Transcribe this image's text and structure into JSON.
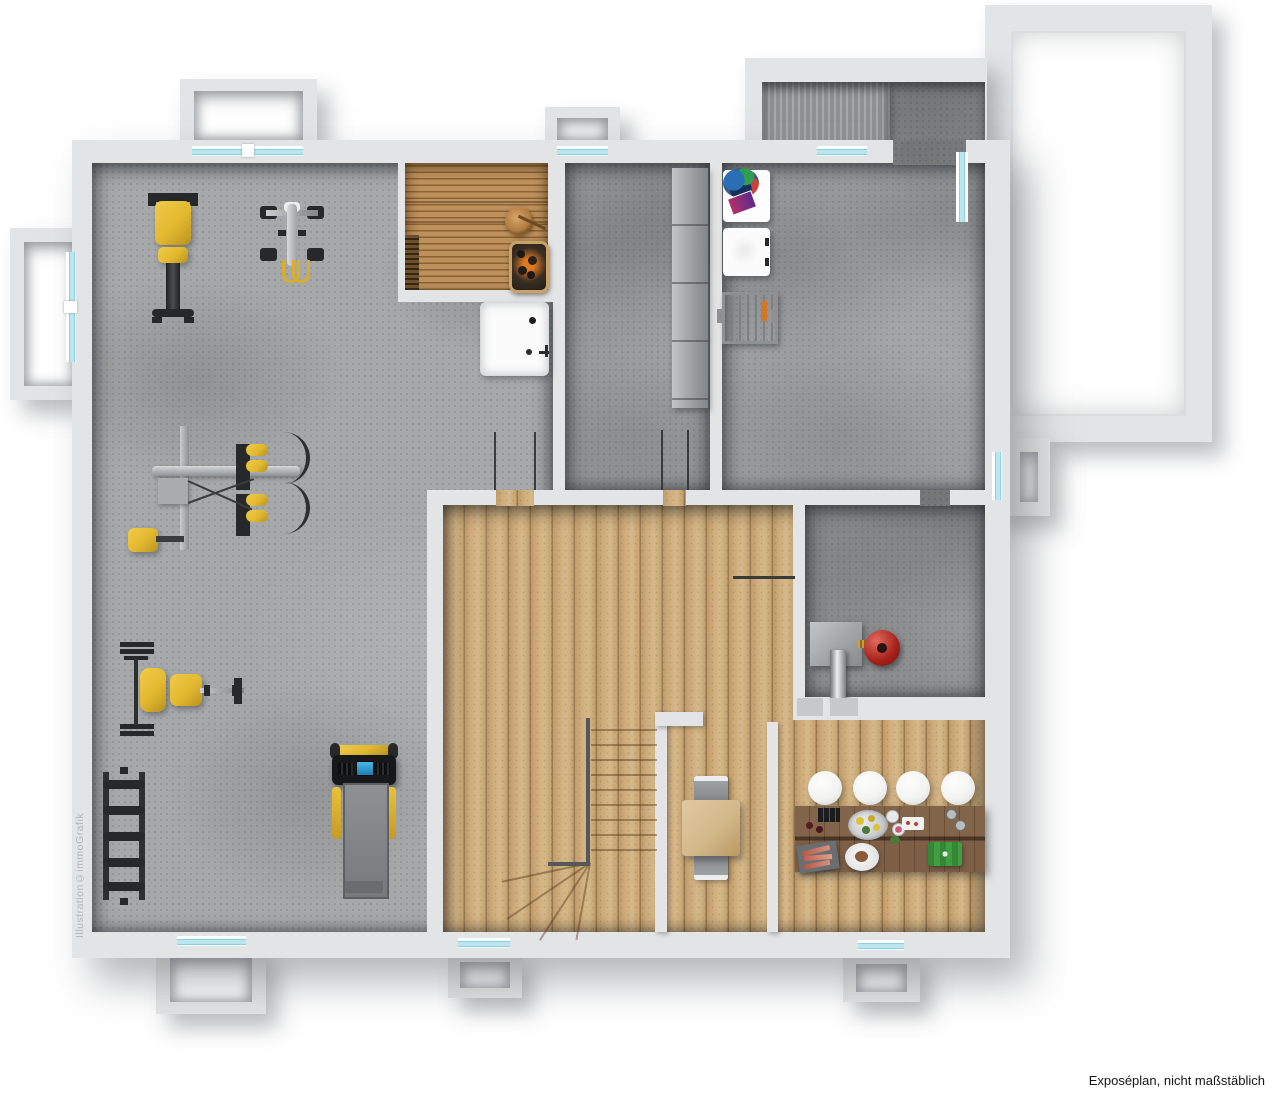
{
  "captions": {
    "disclaimer": "Exposéplan, nicht maßstäblich",
    "watermark": "Illustration©immoGrafik"
  },
  "colors": {
    "wall": "#e3e4e5",
    "concrete_gym": "#a6a8aa",
    "concrete_hall": "#98999b",
    "concrete_laundry": "#9c9ea0",
    "concrete_heating": "#929496",
    "window_glass": "#b9e6ef",
    "wood_floor": "#c9a878",
    "sauna_wood": "#b98d59",
    "bar_counter": "#6f4c30",
    "equipment_yellow": "#e2b82f",
    "equipment_black": "#27282a",
    "metal_gray": "#a6a9ac",
    "boiler_red": "#a8221c",
    "display_blue": "#45b8e8",
    "stool_white": "#f3f3f1",
    "table_wood": "#d3b88b"
  }
}
